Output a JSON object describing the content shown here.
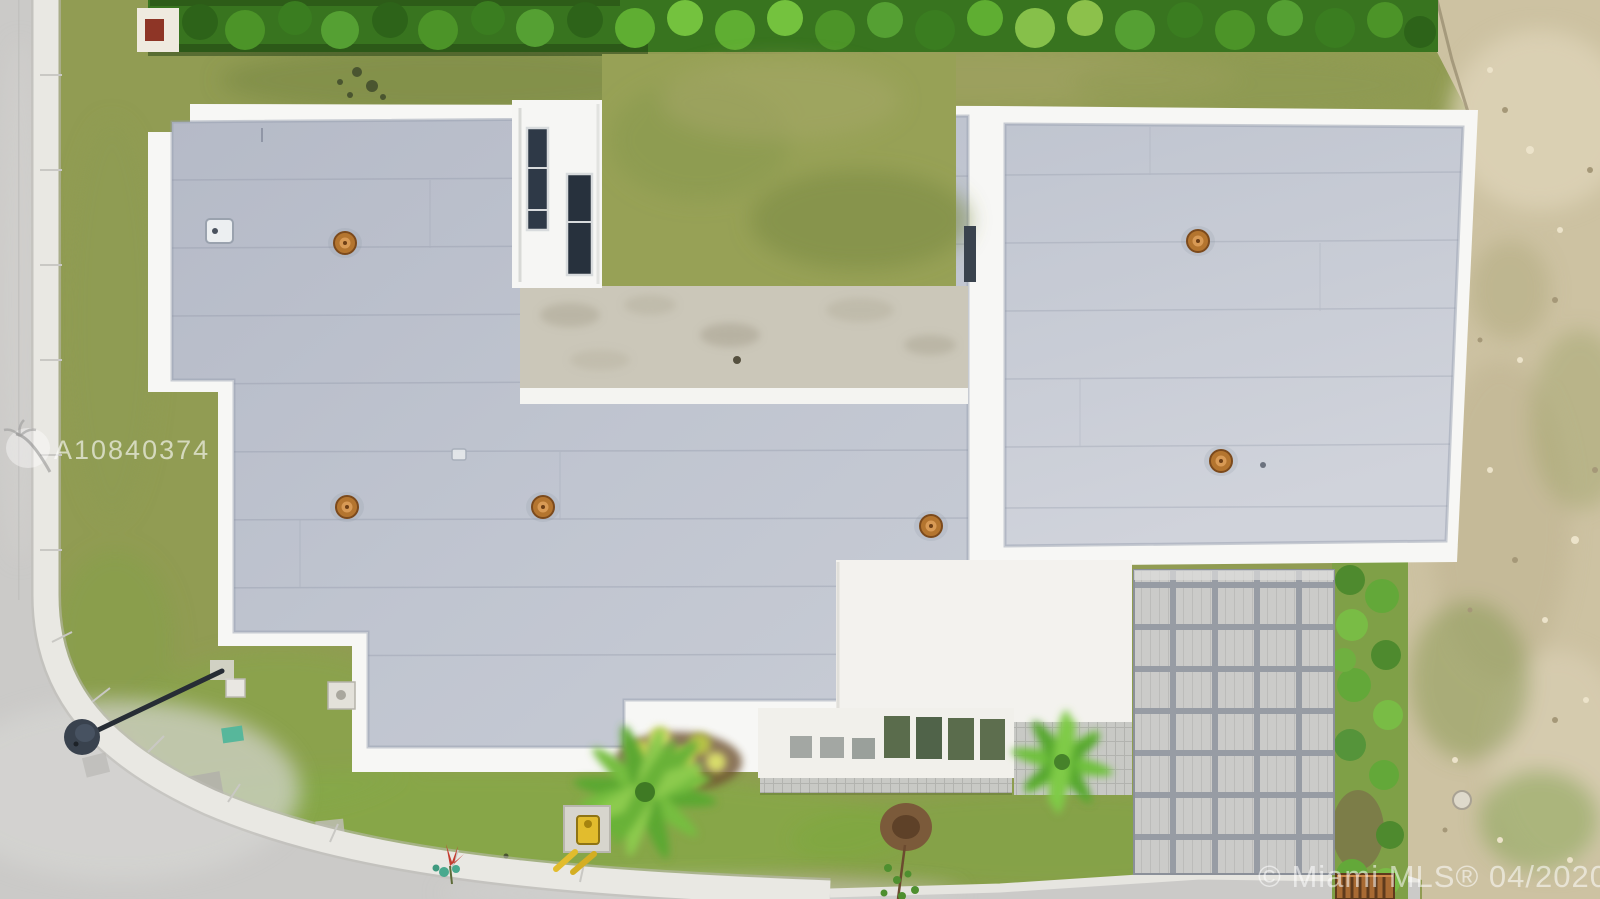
{
  "image": {
    "kind": "aerial-drone-photo",
    "description": "Top-down aerial photo of a modern flat-roof single-family house on a corner lot with street at left/bottom, hedge at top, paver driveway and sandy vacant lot at right",
    "width": 1600,
    "height": 899
  },
  "watermarks": {
    "listing_id": "A10840374",
    "copyright": "© Miami MLS® 04/2020",
    "logo": "miami-mls-palm-logo"
  },
  "palette": {
    "grass_base": "#919c53",
    "grass_bright": "#7fae3f",
    "grass_dark": "#73883f",
    "hedge_green": "#38741f",
    "hedge_light": "#5fae32",
    "roof_gray": "#bcc1cc",
    "roof_gray_light": "#ced2da",
    "parapet_white": "#f7f7f5",
    "balcony_concrete": "#cbc7b9",
    "garage_white": "#f3f2ee",
    "asphalt": "#cbcac8",
    "sidewalk_white": "#e9e8e3",
    "paver_gray": "#cbcbc9",
    "paver_grout": "#979ca4",
    "sand": "#cdc2a2",
    "drain_rust": "#b4752f",
    "lamp_dark": "#39424e",
    "valve_yellow": "#e2bc2d",
    "grate_orange": "#a86a33",
    "marker_teal": "#57b79b",
    "utility_red": "#8e3526"
  },
  "scene_objects": [
    "street-left",
    "sidewalk-curve",
    "street-lamp",
    "hedge-row",
    "house-flat-roof-left-wing",
    "house-flat-roof-right-wing",
    "stair-tower-skylights",
    "courtyard-lawn",
    "concrete-balcony",
    "garage-roof",
    "pergola-trellis",
    "paver-driveway",
    "roof-drains",
    "palm-trees",
    "yellow-shrub-bed",
    "tree-sapling",
    "vacant-sand-lot",
    "shrub-row",
    "water-valve",
    "orange-grate",
    "utility-pads",
    "listing-watermark",
    "copyright-watermark"
  ]
}
